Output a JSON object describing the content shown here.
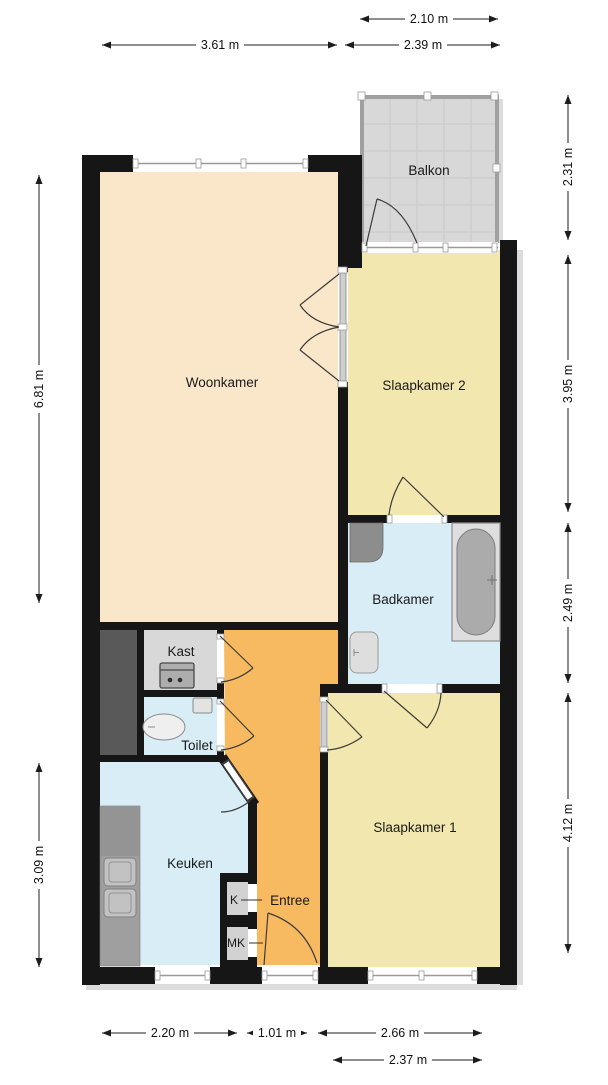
{
  "floorplan": {
    "rooms": [
      {
        "name": "Woonkamer"
      },
      {
        "name": "Slaapkamer 2"
      },
      {
        "name": "Slaapkamer 1"
      },
      {
        "name": "Badkamer"
      },
      {
        "name": "Keuken"
      },
      {
        "name": "Toilet"
      },
      {
        "name": "Kast"
      },
      {
        "name": "Entree"
      },
      {
        "name": "Balkon"
      },
      {
        "name": "K"
      },
      {
        "name": "MK"
      }
    ],
    "dimensions_m": {
      "top": [
        "2.10 m",
        "3.61 m",
        "2.39 m"
      ],
      "left": [
        "6.81 m",
        "3.09 m"
      ],
      "right": [
        "2.31 m",
        "3.95 m",
        "2.49 m",
        "4.12 m"
      ],
      "bottom": [
        "2.20 m",
        "1.01 m",
        "2.66 m",
        "2.37 m"
      ]
    },
    "colors": {
      "woonkamer": "#fae7c9",
      "slaapkamer": "#f2e7ae",
      "badkamer": "#d8edf6",
      "entree": "#f7ba60",
      "kast": "#d8d8d8",
      "balkon": "#d8d8d8",
      "kast_klein": "#d2d2d2",
      "wall": "#161616",
      "shaft": "#595959",
      "fixture_gray": "#dedede",
      "counter_gray": "#9f9f9f"
    }
  }
}
